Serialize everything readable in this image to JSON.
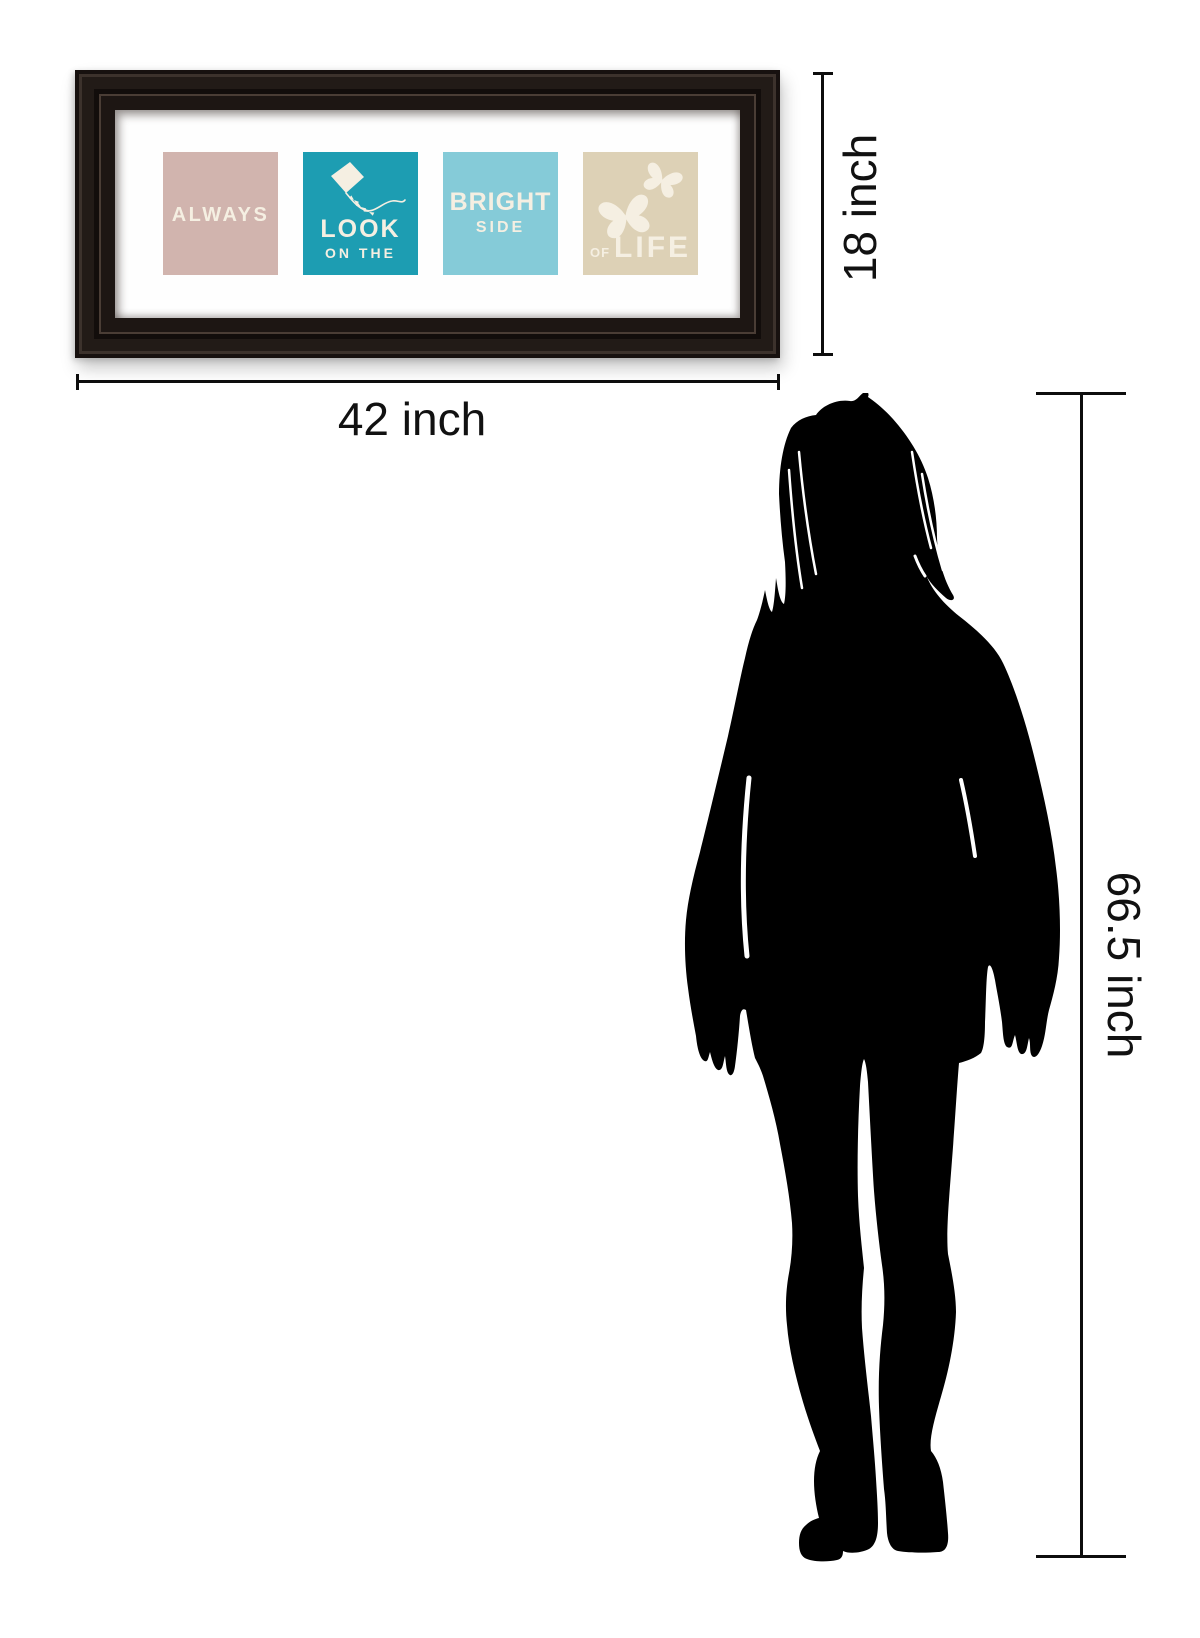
{
  "artwork": {
    "frame_color": "#1d1613",
    "mat_color": "#ffffff",
    "text_color": "#f5efe2",
    "panels": [
      {
        "name": "always-panel",
        "bg": "#d1b4ae",
        "label": "ALWAYS"
      },
      {
        "name": "look-on-the-panel",
        "bg": "#1d9db2",
        "icon": "kite-icon",
        "label_line1": "LOOK",
        "label_line2": "ON THE"
      },
      {
        "name": "bright-side-panel",
        "bg": "#85cbd8",
        "label_line1": "BRIGHT",
        "label_line2": "SIDE"
      },
      {
        "name": "of-life-panel",
        "bg": "#ddd1b6",
        "icon": "butterflies-icon",
        "label_line1": "OF",
        "label_line2": "LIFE"
      }
    ]
  },
  "dimensions": {
    "frame_width_label": "42 inch",
    "frame_height_label": "18 inch",
    "person_height_label": "66.5 inch",
    "line_color": "#0d0d0d",
    "label_color": "#111111"
  },
  "figure": {
    "name": "woman-silhouette",
    "color": "#000000"
  }
}
